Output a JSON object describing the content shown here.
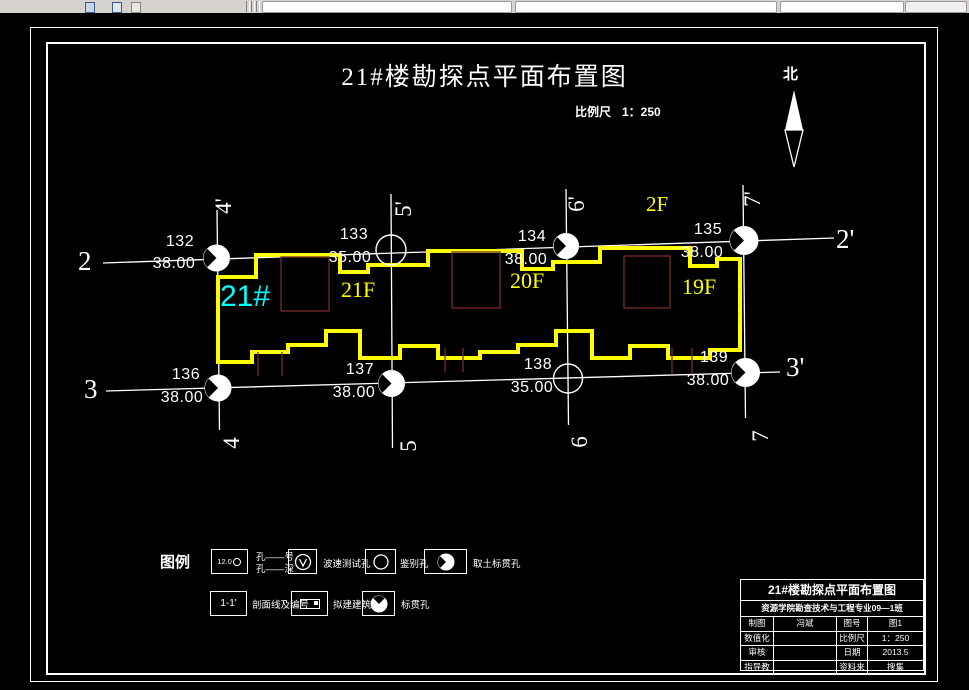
{
  "drawing": {
    "title": "21#楼勘探点平面布置图",
    "scale": {
      "label": "比例尺",
      "value": "1：250"
    },
    "north_label": "北",
    "axes": {
      "h_top_left": "2",
      "h_top_right": "2'",
      "h_bottom_left": "3",
      "h_bottom_right": "3'",
      "v_top": [
        "4'",
        "5'",
        "6'",
        "7'"
      ],
      "v_bottom": [
        "4",
        "5",
        "6",
        "7"
      ]
    },
    "boreholes": [
      {
        "id": "132",
        "elevation": "38.00"
      },
      {
        "id": "133",
        "elevation": "35.00"
      },
      {
        "id": "134",
        "elevation": "38.00"
      },
      {
        "id": "135",
        "elevation": "38.00"
      },
      {
        "id": "136",
        "elevation": "38.00"
      },
      {
        "id": "137",
        "elevation": "38.00"
      },
      {
        "id": "138",
        "elevation": "35.00"
      },
      {
        "id": "139",
        "elevation": "38.00"
      }
    ],
    "building_labels": {
      "block": "21#",
      "units": [
        "21F",
        "20F",
        "19F"
      ],
      "annex": "2F"
    },
    "legend": {
      "title": "图例",
      "row1": [
        {
          "symbol_text": "12.0",
          "label_top": "孔——号",
          "label_bottom": "孔——深"
        },
        {
          "label": "波速测试孔"
        },
        {
          "label": "鉴别孔"
        },
        {
          "label": "取土标贯孔"
        }
      ],
      "row2": [
        {
          "symbol_text": "1-1'",
          "label": "剖面线及编号"
        },
        {
          "label": "拟建建筑"
        },
        {
          "label": "标贯孔"
        }
      ]
    },
    "titleblock": {
      "title": "21#楼勘探点平面布置图",
      "subtitle": "资源学院勘查技术与工程专业09—1班",
      "rows": [
        {
          "k1": "制图",
          "v1": "冯斌",
          "k2": "图号",
          "v2": "图1"
        },
        {
          "k1": "数值化",
          "v1": "",
          "k2": "比例尺",
          "v2": "1：250"
        },
        {
          "k1": "审核",
          "v1": "",
          "k2": "日期",
          "v2": "2013.5"
        },
        {
          "k1": "指导教师",
          "v1": "",
          "k2": "资料来源",
          "v2": "搜集"
        }
      ]
    },
    "colors": {
      "outline": "#ffff00",
      "block_label": "#00ffff",
      "annotation": "#ffffff",
      "building_inner": "#7a2a2a"
    }
  }
}
